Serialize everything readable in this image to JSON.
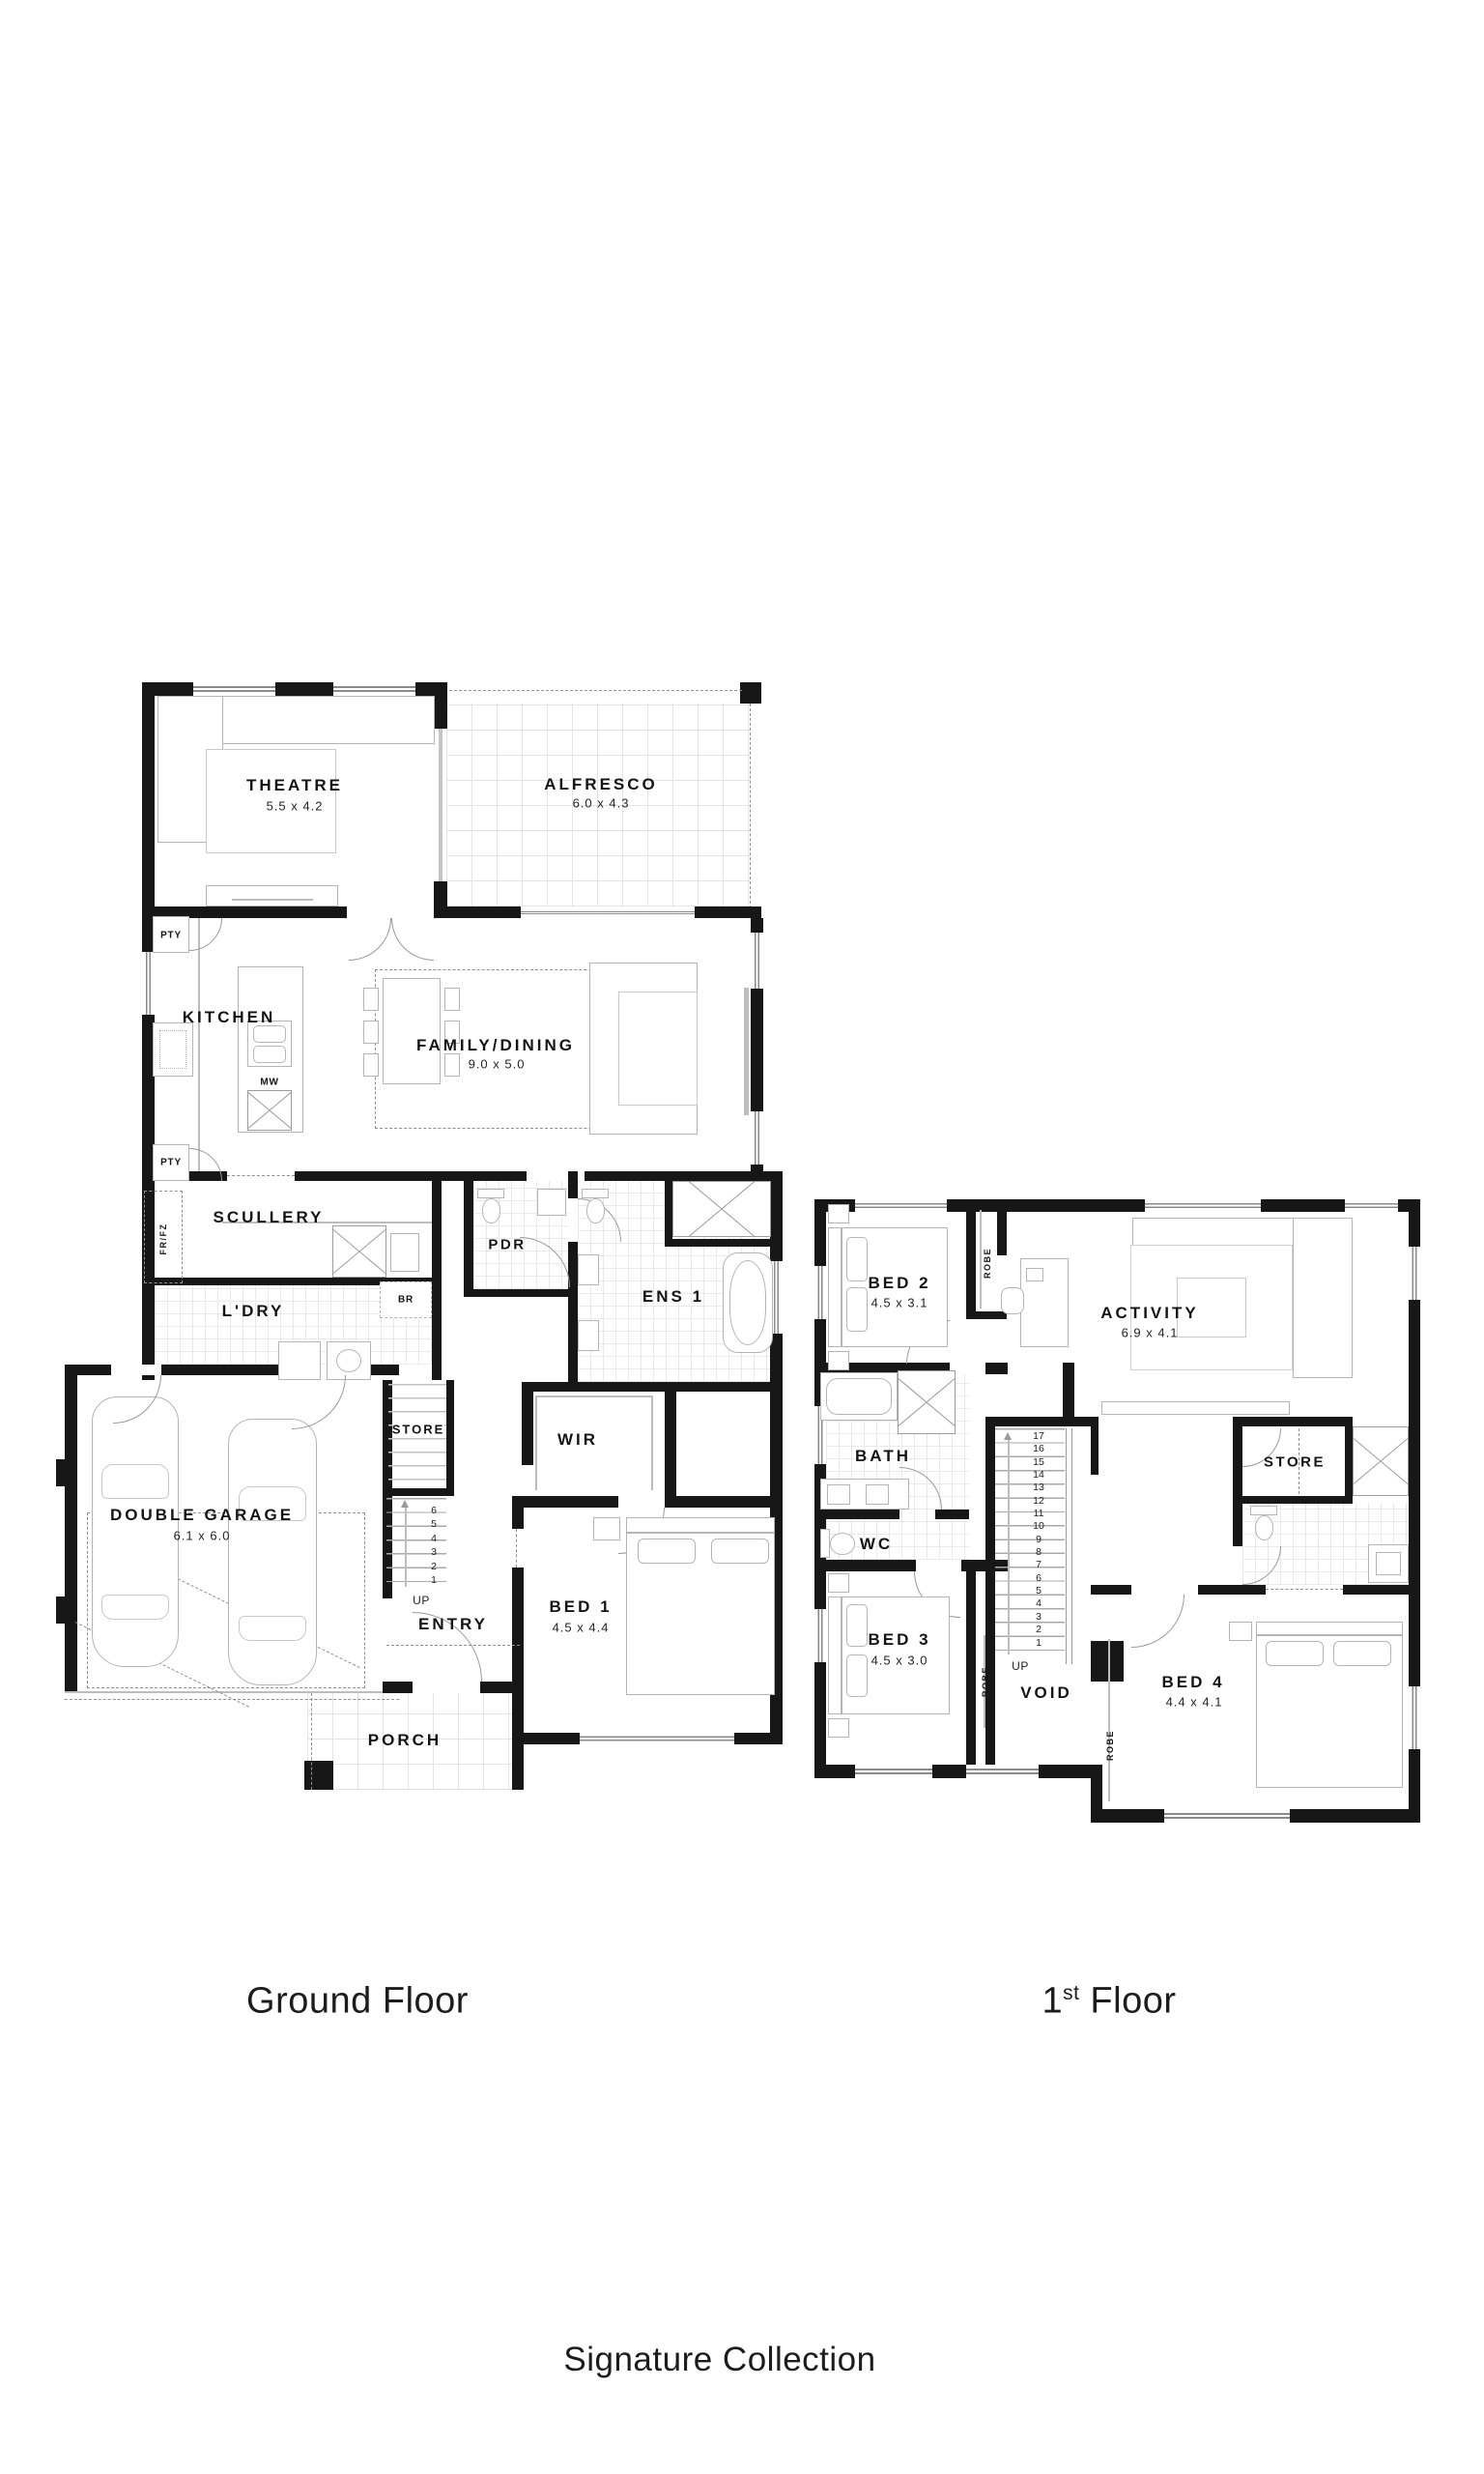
{
  "captions": {
    "ground_floor": "Ground Floor",
    "first_floor_num": "1",
    "first_floor_sup": "st",
    "first_floor_rest": " Floor",
    "collection": "Signature Collection"
  },
  "ground": {
    "theatre": {
      "name": "THEATRE",
      "dim": "5.5 x 4.2"
    },
    "alfresco": {
      "name": "ALFRESCO",
      "dim": "6.0 x 4.3"
    },
    "kitchen": {
      "name": "KITCHEN"
    },
    "family": {
      "name": "FAMILY/DINING",
      "dim": "9.0 x 5.0"
    },
    "scullery": {
      "name": "SCULLERY"
    },
    "ldry": {
      "name": "L'DRY"
    },
    "pdr": {
      "name": "PDR"
    },
    "ens1": {
      "name": "ENS 1"
    },
    "wir": {
      "name": "WIR"
    },
    "store": {
      "name": "STORE"
    },
    "entry": {
      "name": "ENTRY"
    },
    "porch": {
      "name": "PORCH"
    },
    "bed1": {
      "name": "BED 1",
      "dim": "4.5 x 4.4"
    },
    "garage": {
      "name": "DOUBLE GARAGE",
      "dim": "6.1 x 6.0"
    },
    "pty": "PTY",
    "frfz": "FR/FZ",
    "br": "BR",
    "mw": "MW",
    "up": "UP",
    "stair_numbers": [
      "6",
      "5",
      "4",
      "3",
      "2",
      "1"
    ]
  },
  "first": {
    "bed2": {
      "name": "BED 2",
      "dim": "4.5 x 3.1"
    },
    "activity": {
      "name": "ACTIVITY",
      "dim": "6.9 x 4.1"
    },
    "bath": {
      "name": "BATH"
    },
    "wc": {
      "name": "WC"
    },
    "store": {
      "name": "STORE"
    },
    "void": {
      "name": "VOID"
    },
    "bed3": {
      "name": "BED 3",
      "dim": "4.5 x 3.0"
    },
    "bed4": {
      "name": "BED 4",
      "dim": "4.4 x 4.1"
    },
    "robe": "ROBE",
    "up": "UP",
    "stair_numbers": [
      "17",
      "16",
      "15",
      "14",
      "13",
      "12",
      "11",
      "10",
      "9",
      "8",
      "7",
      "6",
      "5",
      "4",
      "3",
      "2",
      "1"
    ]
  }
}
